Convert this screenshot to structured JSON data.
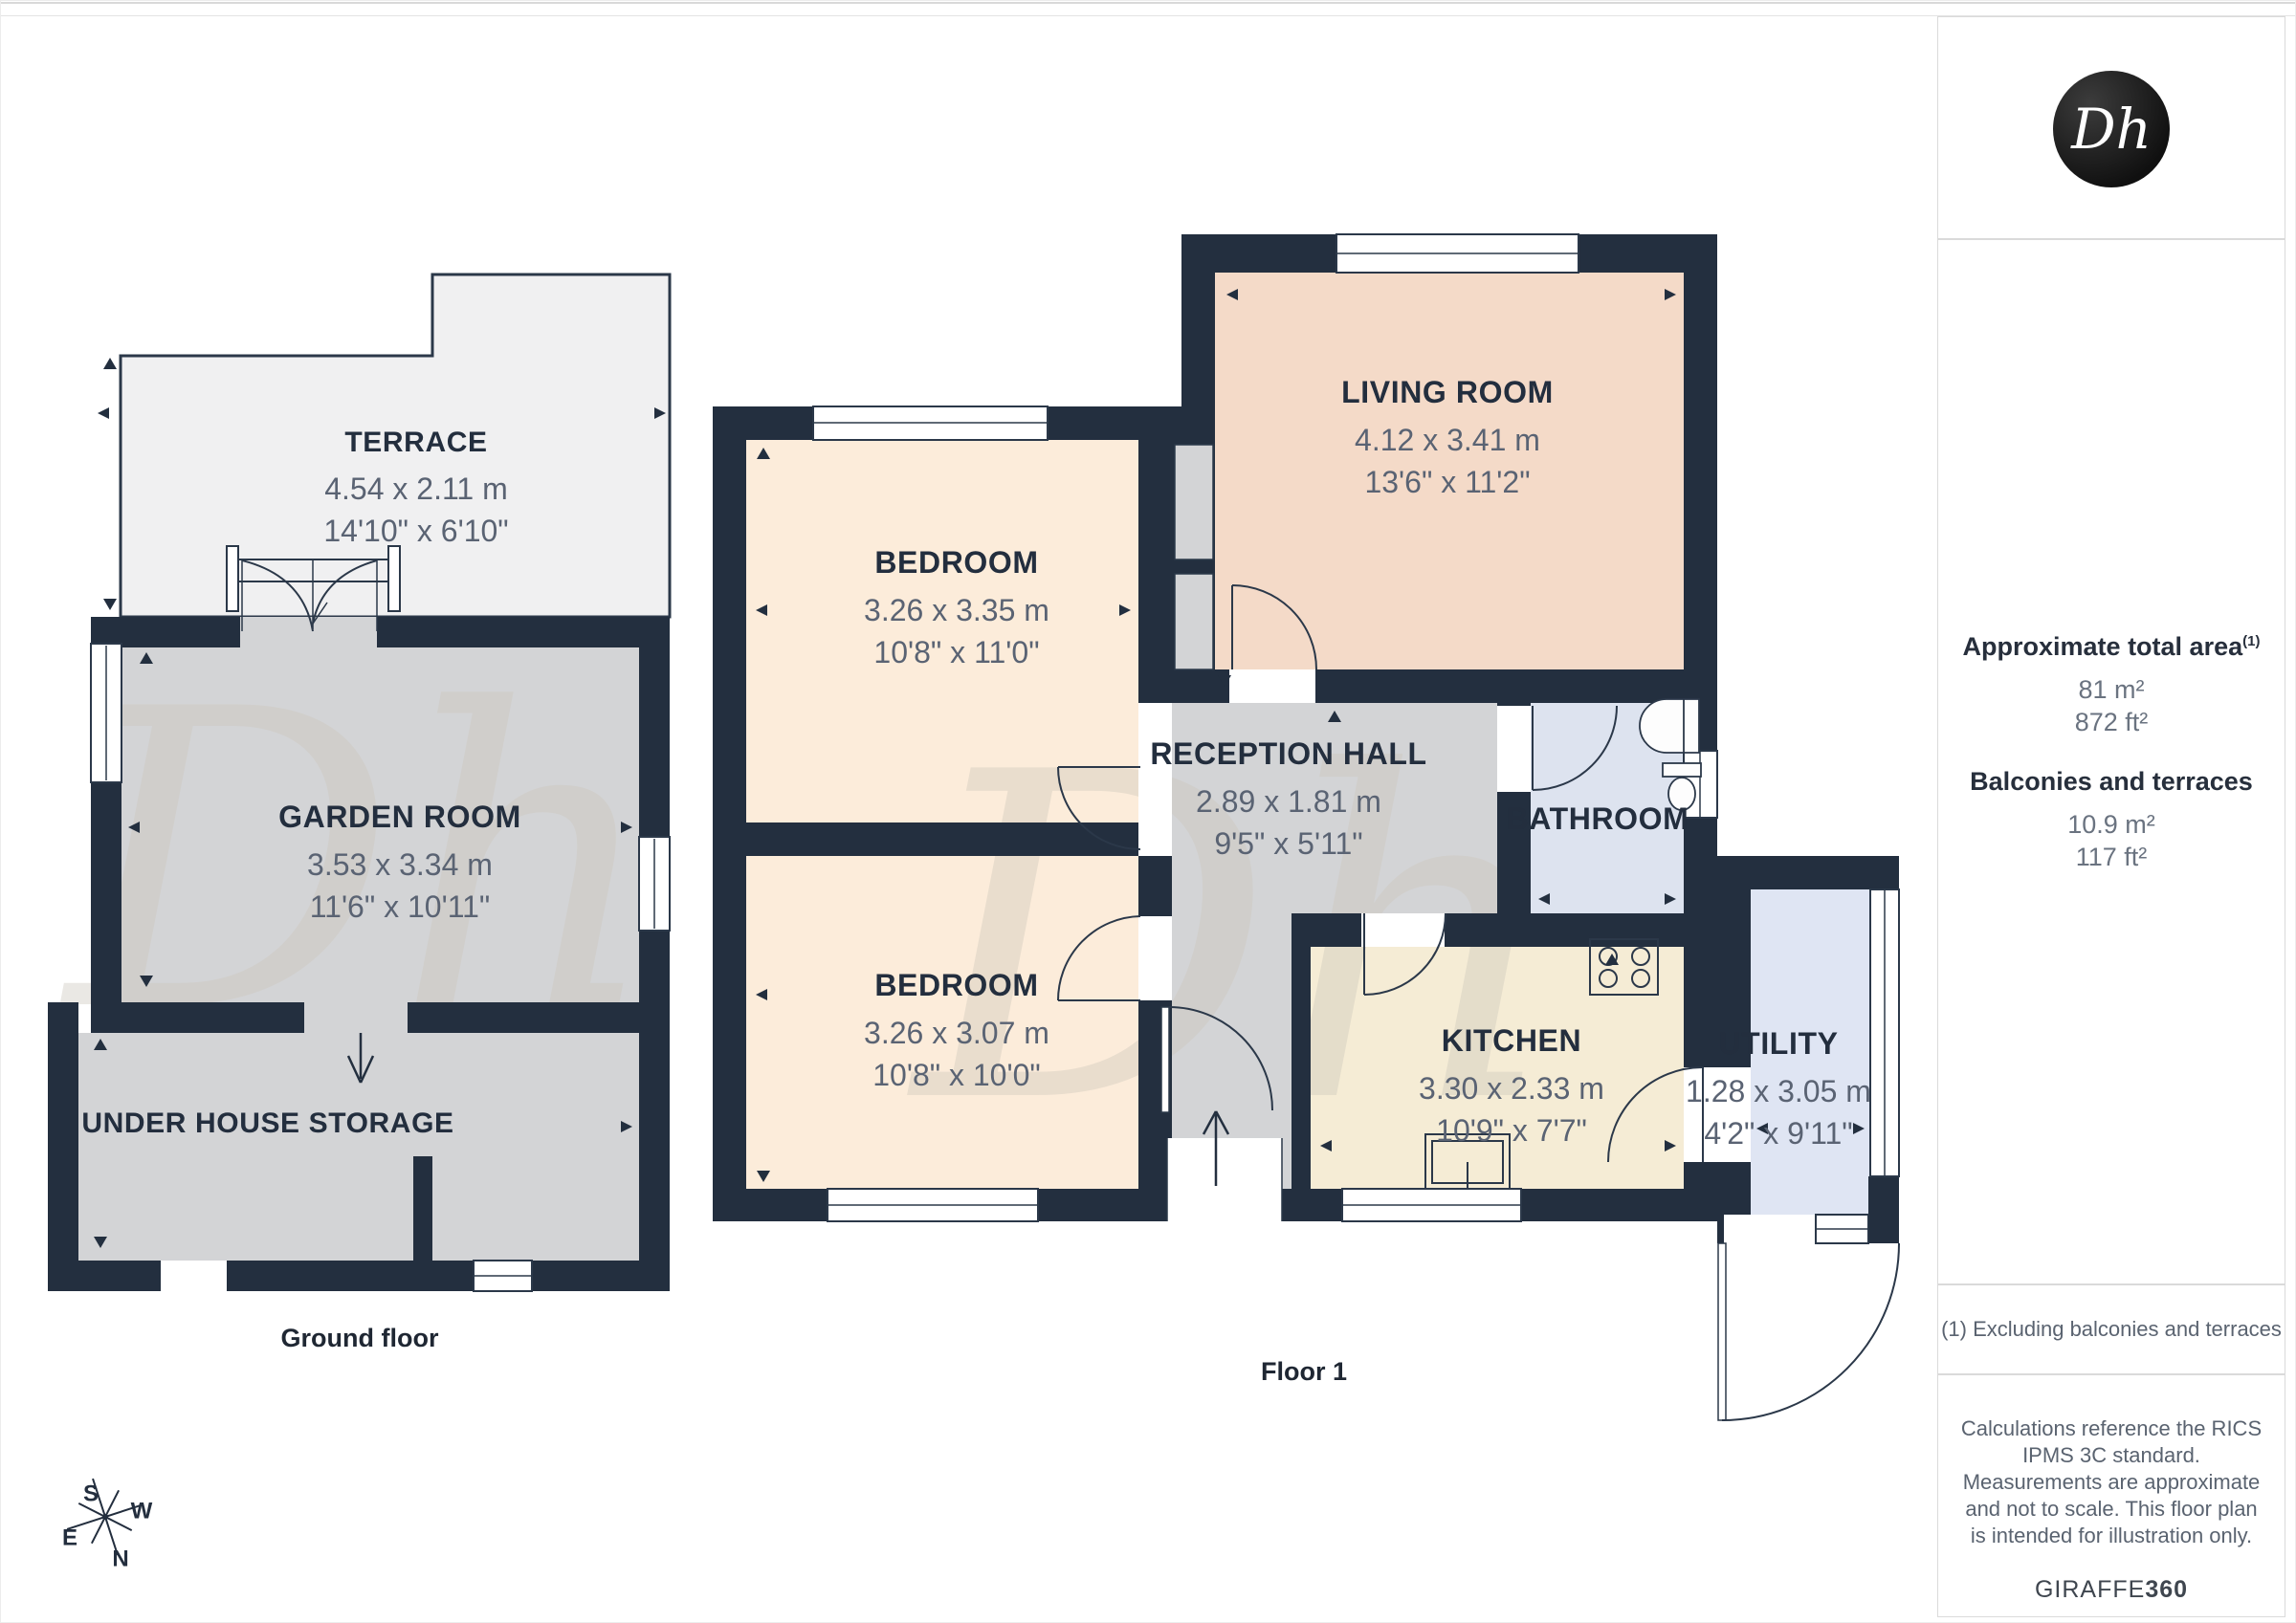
{
  "branding": {
    "logo_text": "Dh",
    "provider": "GIRAFFE",
    "provider_suffix": "360"
  },
  "sidebar": {
    "total_area": {
      "heading": "Approximate total area",
      "superscript": "(1)",
      "metric": "81 m²",
      "imperial": "872 ft²"
    },
    "balconies": {
      "heading": "Balconies and terraces",
      "metric": "10.9 m²",
      "imperial": "117 ft²"
    },
    "footnote": "(1) Excluding balconies and terraces",
    "disclaimer": "Calculations reference the RICS IPMS 3C standard. Measurements are approximate and not to scale. This floor plan is intended for illustration only."
  },
  "floors": {
    "ground": {
      "caption": "Ground floor",
      "rooms": {
        "terrace": {
          "name": "TERRACE",
          "metric": "4.54 x 2.11 m",
          "imperial": "14'10\" x 6'10\""
        },
        "garden_room": {
          "name": "GARDEN ROOM",
          "metric": "3.53 x 3.34 m",
          "imperial": "11'6\" x 10'11\""
        },
        "storage": {
          "name": "UNDER HOUSE STORAGE"
        }
      }
    },
    "first": {
      "caption": "Floor 1",
      "rooms": {
        "bedroom_a": {
          "name": "BEDROOM",
          "metric": "3.26 x 3.35 m",
          "imperial": "10'8\" x 11'0\""
        },
        "bedroom_b": {
          "name": "BEDROOM",
          "metric": "3.26 x 3.07 m",
          "imperial": "10'8\" x 10'0\""
        },
        "living_room": {
          "name": "LIVING ROOM",
          "metric": "4.12 x 3.41 m",
          "imperial": "13'6\" x 11'2\""
        },
        "reception_hall": {
          "name": "RECEPTION HALL",
          "metric": "2.89 x 1.81 m",
          "imperial": "9'5\" x 5'11\""
        },
        "bathroom": {
          "name": "BATHROOM"
        },
        "kitchen": {
          "name": "KITCHEN",
          "metric": "3.30 x 2.33 m",
          "imperial": "10'9\" x 7'7\""
        },
        "utility": {
          "name": "UTILITY",
          "metric": "1.28 x 3.05 m",
          "imperial": "4'2\" x 9'11\""
        }
      }
    }
  },
  "compass": {
    "n": "N",
    "s": "S",
    "e": "E",
    "w": "W"
  },
  "colors": {
    "wall": "#232f3f",
    "floor_gray": "#d3d4d6",
    "bedroom": "#fcecda",
    "living": "#f4dac8",
    "bathroom": "#dde3ef",
    "kitchen": "#f5ecd5",
    "utility": "#dfe5f3",
    "terrace": "#f0f0f1",
    "label_dark": "#232e3e",
    "label_gray": "#5a6373"
  }
}
